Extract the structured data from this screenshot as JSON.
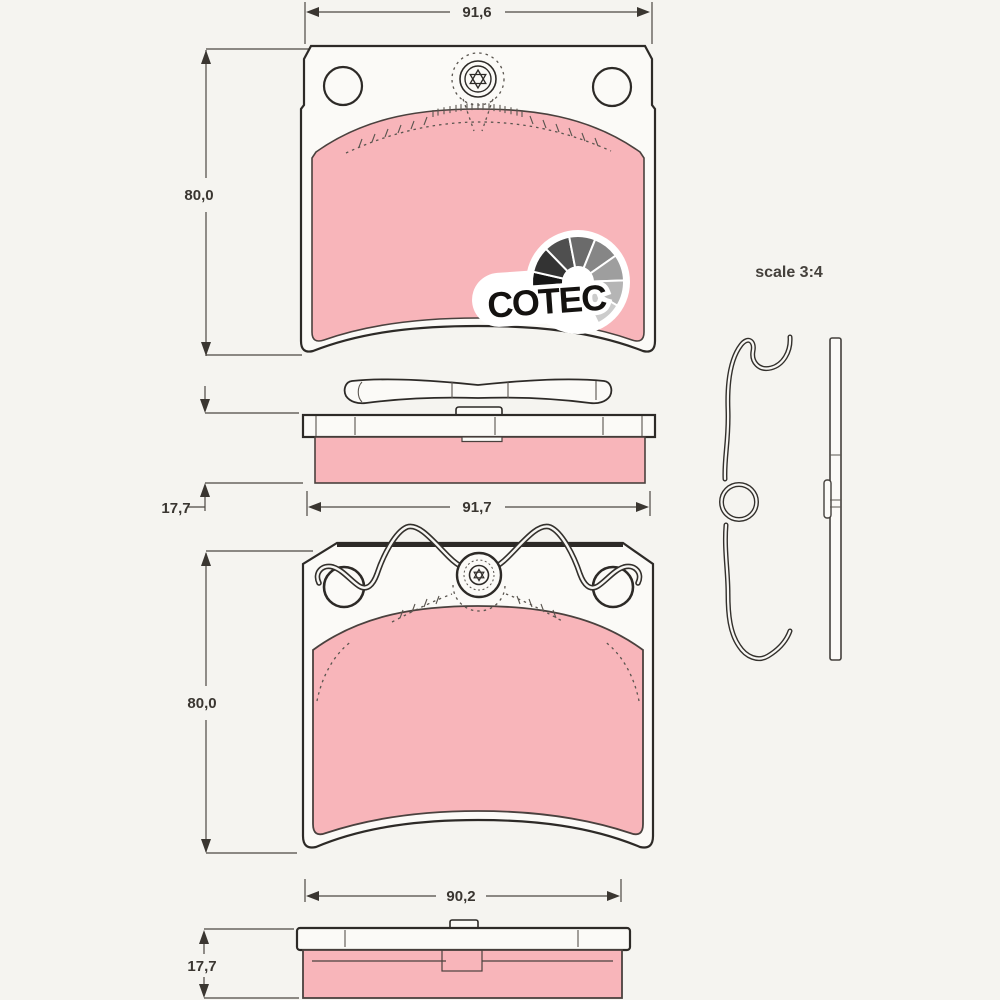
{
  "drawing": {
    "scale_note": "scale 3:4",
    "logo": {
      "text": "COTEC",
      "emblem_icon": "grayscale-fan-arc"
    },
    "colors": {
      "friction_material": "#f8b5ba",
      "plate_fill": "#fbfaf7",
      "outline": "#2d2a27",
      "dimension": "#4c4742",
      "background": "#f5f4f0"
    },
    "dimensions": {
      "top_pad_width": "91,6",
      "top_pad_height": "80,0",
      "top_side_thickness": "17,7",
      "top_side_length": "91,7",
      "bottom_pad_height": "80,0",
      "bottom_side_width": "90,2",
      "bottom_side_thickness": "17,7"
    }
  }
}
